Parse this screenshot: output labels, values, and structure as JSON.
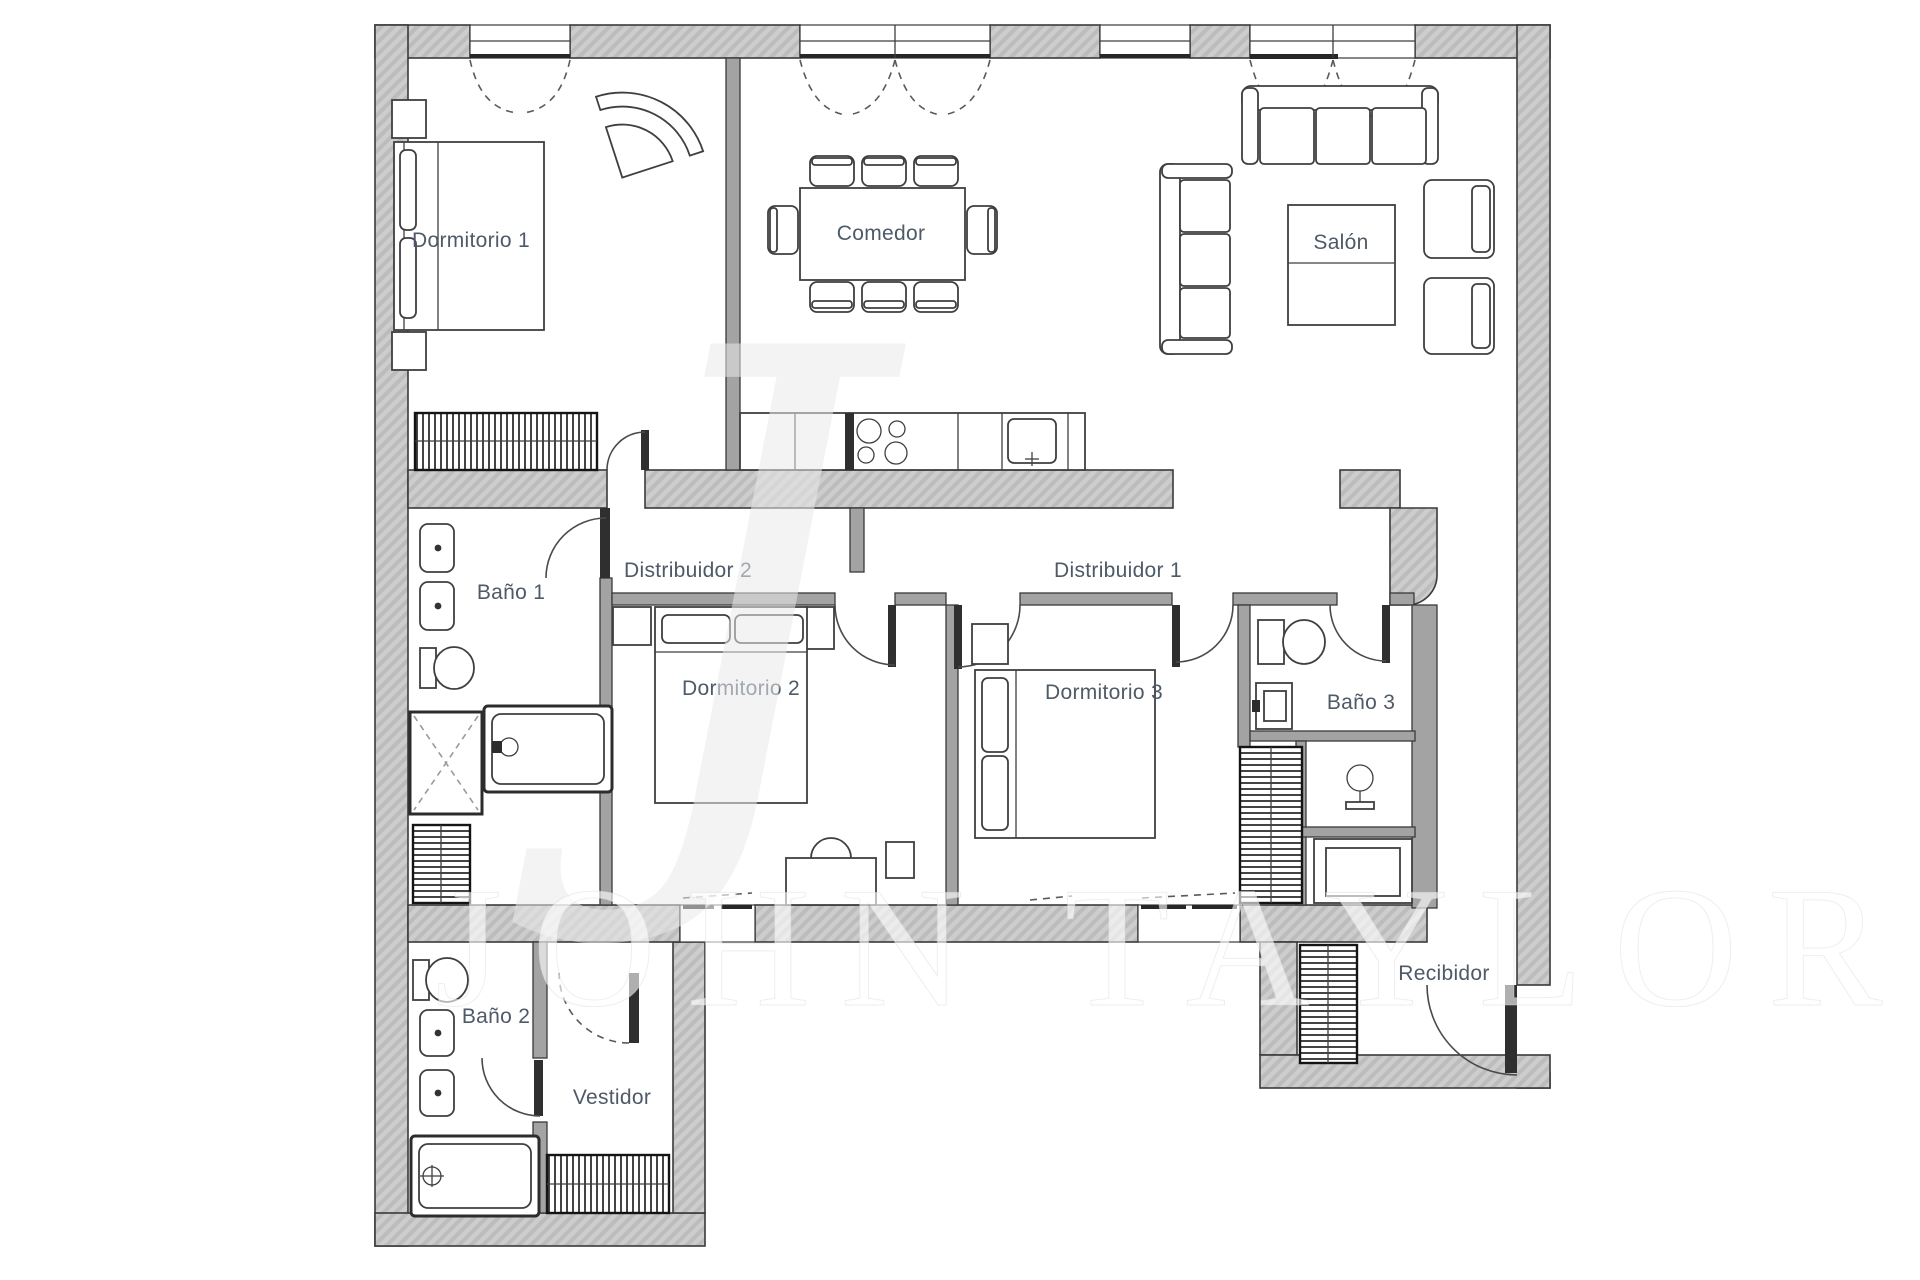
{
  "plan": {
    "type": "apartment-floor-plan",
    "rooms": [
      {
        "label": "Dormitorio 1"
      },
      {
        "label": "Comedor"
      },
      {
        "label": "Salón"
      },
      {
        "label": "Baño 1"
      },
      {
        "label": "Distribuidor 2"
      },
      {
        "label": "Distribuidor 1"
      },
      {
        "label": "Dormitorio 2"
      },
      {
        "label": "Dormitorio 3"
      },
      {
        "label": "Baño 3"
      },
      {
        "label": "Baño 2"
      },
      {
        "label": "Vestidor"
      },
      {
        "label": "Recibidor"
      }
    ],
    "watermark": {
      "monogram": "J",
      "brand": "JOHN TAYLOR"
    },
    "colors": {
      "background": "#ffffff",
      "wall_fill": "#cdcdcd",
      "wall_hatch": "#bcbcbc",
      "wall_stroke": "#3a3a3a",
      "thin_wall_fill": "#a3a3a3",
      "label_color": "#4e5a68",
      "furniture_stroke": "#3f3f3f",
      "watermark_color": "#ffffff"
    }
  }
}
